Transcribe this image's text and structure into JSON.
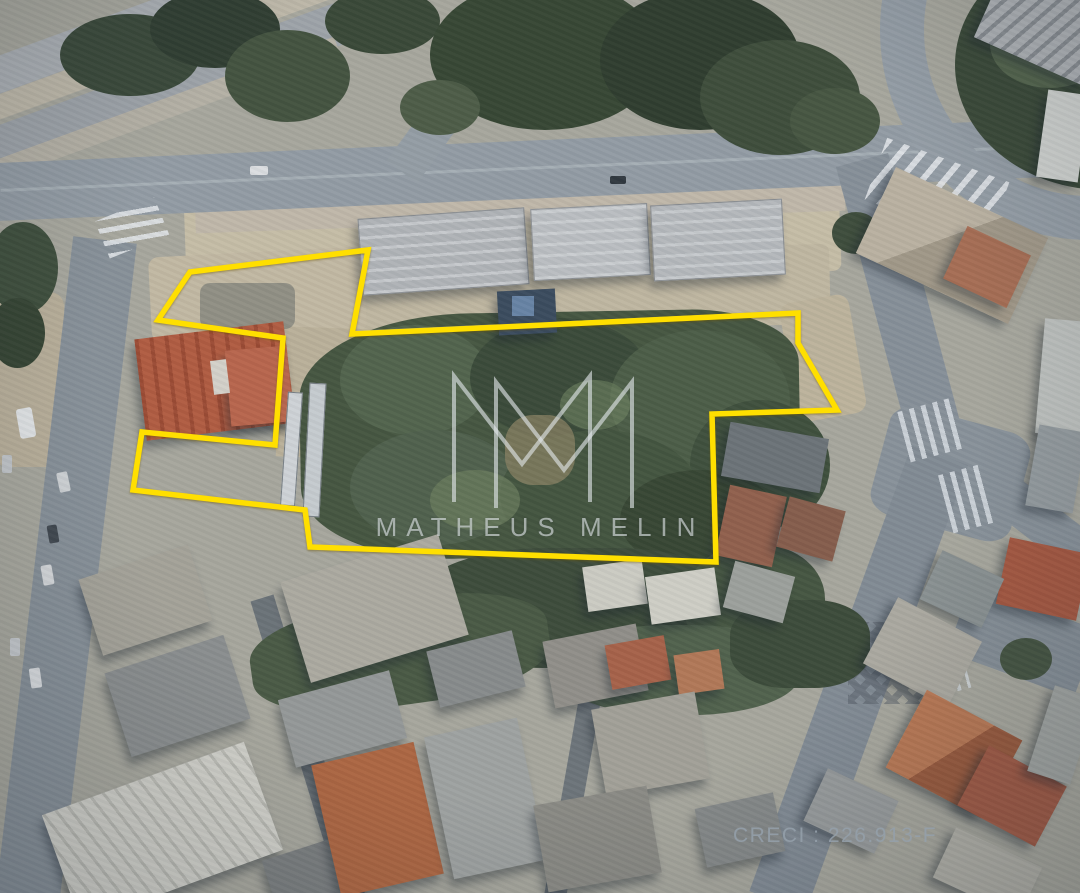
{
  "image": {
    "kind": "aerial-satellite-photo",
    "description": "Top-down satellite view of an urban block with a vacant wooded parcel outlined in yellow",
    "width_px": 1080,
    "height_px": 893
  },
  "boundary": {
    "color": "#ffdf00",
    "stroke_width": 5.5,
    "points": [
      [
        190,
        272
      ],
      [
        368,
        250
      ],
      [
        352,
        334
      ],
      [
        798,
        313
      ],
      [
        798,
        343
      ],
      [
        837,
        410
      ],
      [
        712,
        414
      ],
      [
        716,
        562
      ],
      [
        310,
        547
      ],
      [
        305,
        510
      ],
      [
        133,
        490
      ],
      [
        142,
        432
      ],
      [
        275,
        445
      ],
      [
        283,
        338
      ],
      [
        158,
        320
      ]
    ]
  },
  "watermark": {
    "monogram": "MM",
    "name": "MATHEUS MELIN",
    "color": "rgba(226,231,234,0.62)"
  },
  "license": {
    "label": "CRECI : 226.913-F",
    "color": "rgba(148,159,170,0.88)"
  }
}
